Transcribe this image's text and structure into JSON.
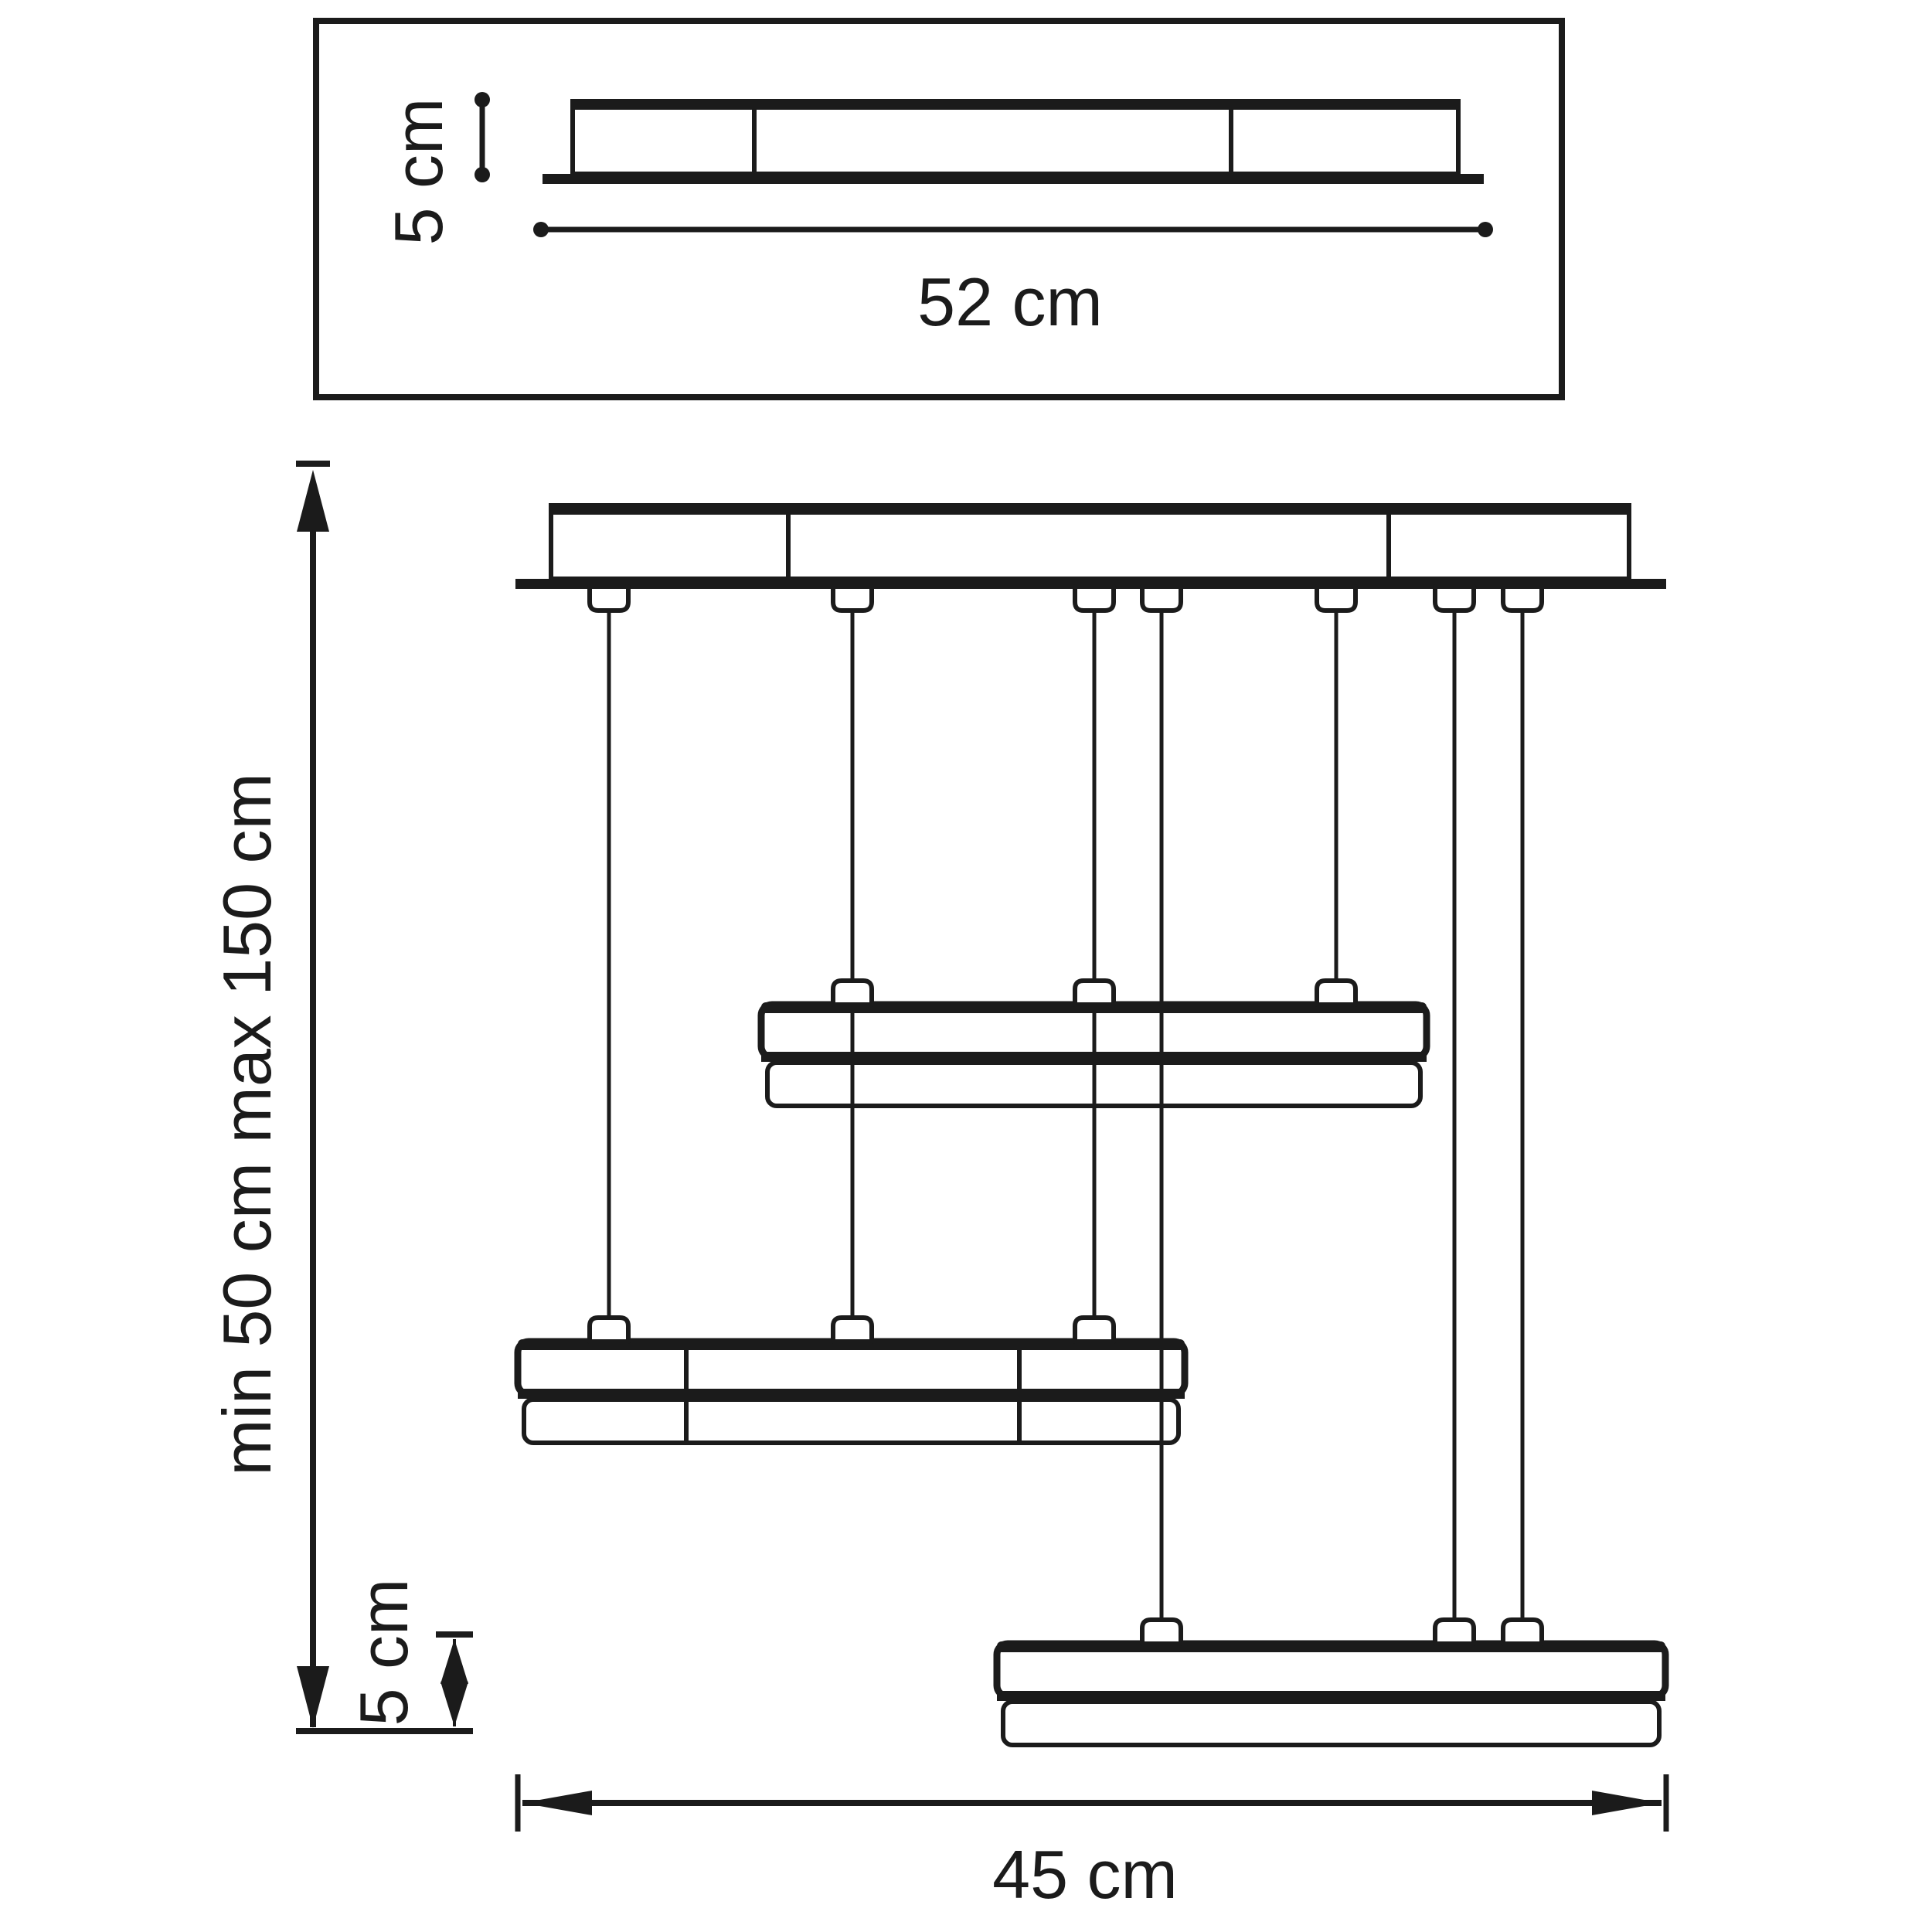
{
  "diagram": {
    "type": "technical-dimension-drawing",
    "subject": "three-tier rectangular pendant chandelier with ceiling canopy",
    "views": {
      "top_view": "ceiling canopy seen from below",
      "front_view": "suspended fixture elevation with three stacked light bars"
    },
    "labels": {
      "canopy_height": "5 cm",
      "canopy_width": "52 cm",
      "suspension_range": "min 50 cm max 150 cm",
      "tier_height": "5 cm",
      "fixture_width": "45 cm"
    },
    "values": {
      "canopy_width_cm": 52,
      "canopy_height_cm": 5,
      "suspension_min_cm": 50,
      "suspension_max_cm": 150,
      "tier_height_cm": 5,
      "fixture_width_cm": 45,
      "suspension_wire_count": 7,
      "tier_count": 3
    },
    "colors": {
      "line": "#1b1b1b",
      "background": "#ffffff"
    }
  }
}
